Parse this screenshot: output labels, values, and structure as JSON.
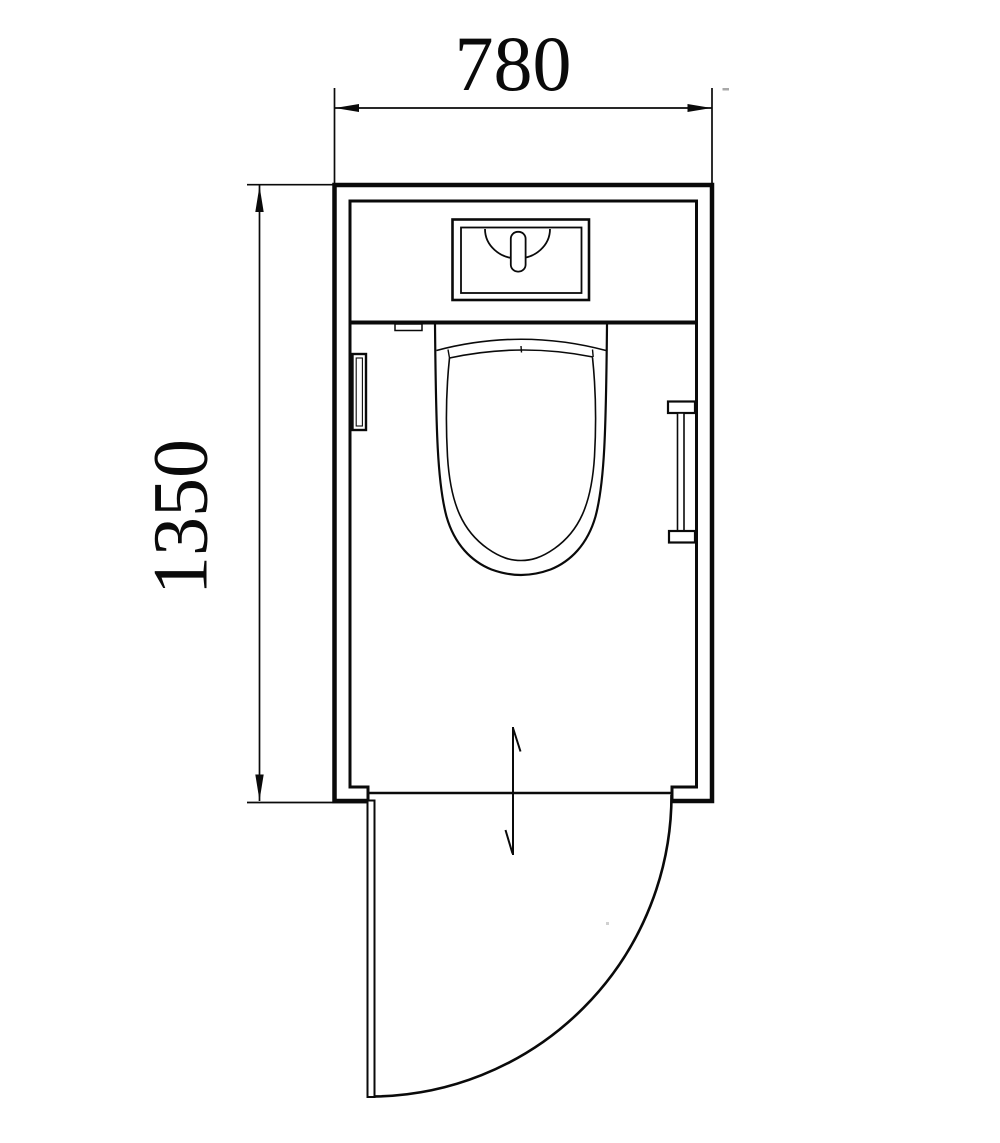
{
  "plan": {
    "title": "toilet-room-floor-plan",
    "dimensions": {
      "width_label": "780",
      "height_label": "1350"
    },
    "colors": {
      "line": "#0a0a0a",
      "background": "#ffffff"
    },
    "fixtures": [
      {
        "name": "washbasin-counter"
      },
      {
        "name": "faucet"
      },
      {
        "name": "toilet"
      },
      {
        "name": "counter-control-panel"
      },
      {
        "name": "toilet-paper-holder"
      },
      {
        "name": "grab-bar"
      },
      {
        "name": "outward-swinging-door"
      },
      {
        "name": "door-swing-arc"
      },
      {
        "name": "swing-direction-arrow"
      }
    ]
  }
}
